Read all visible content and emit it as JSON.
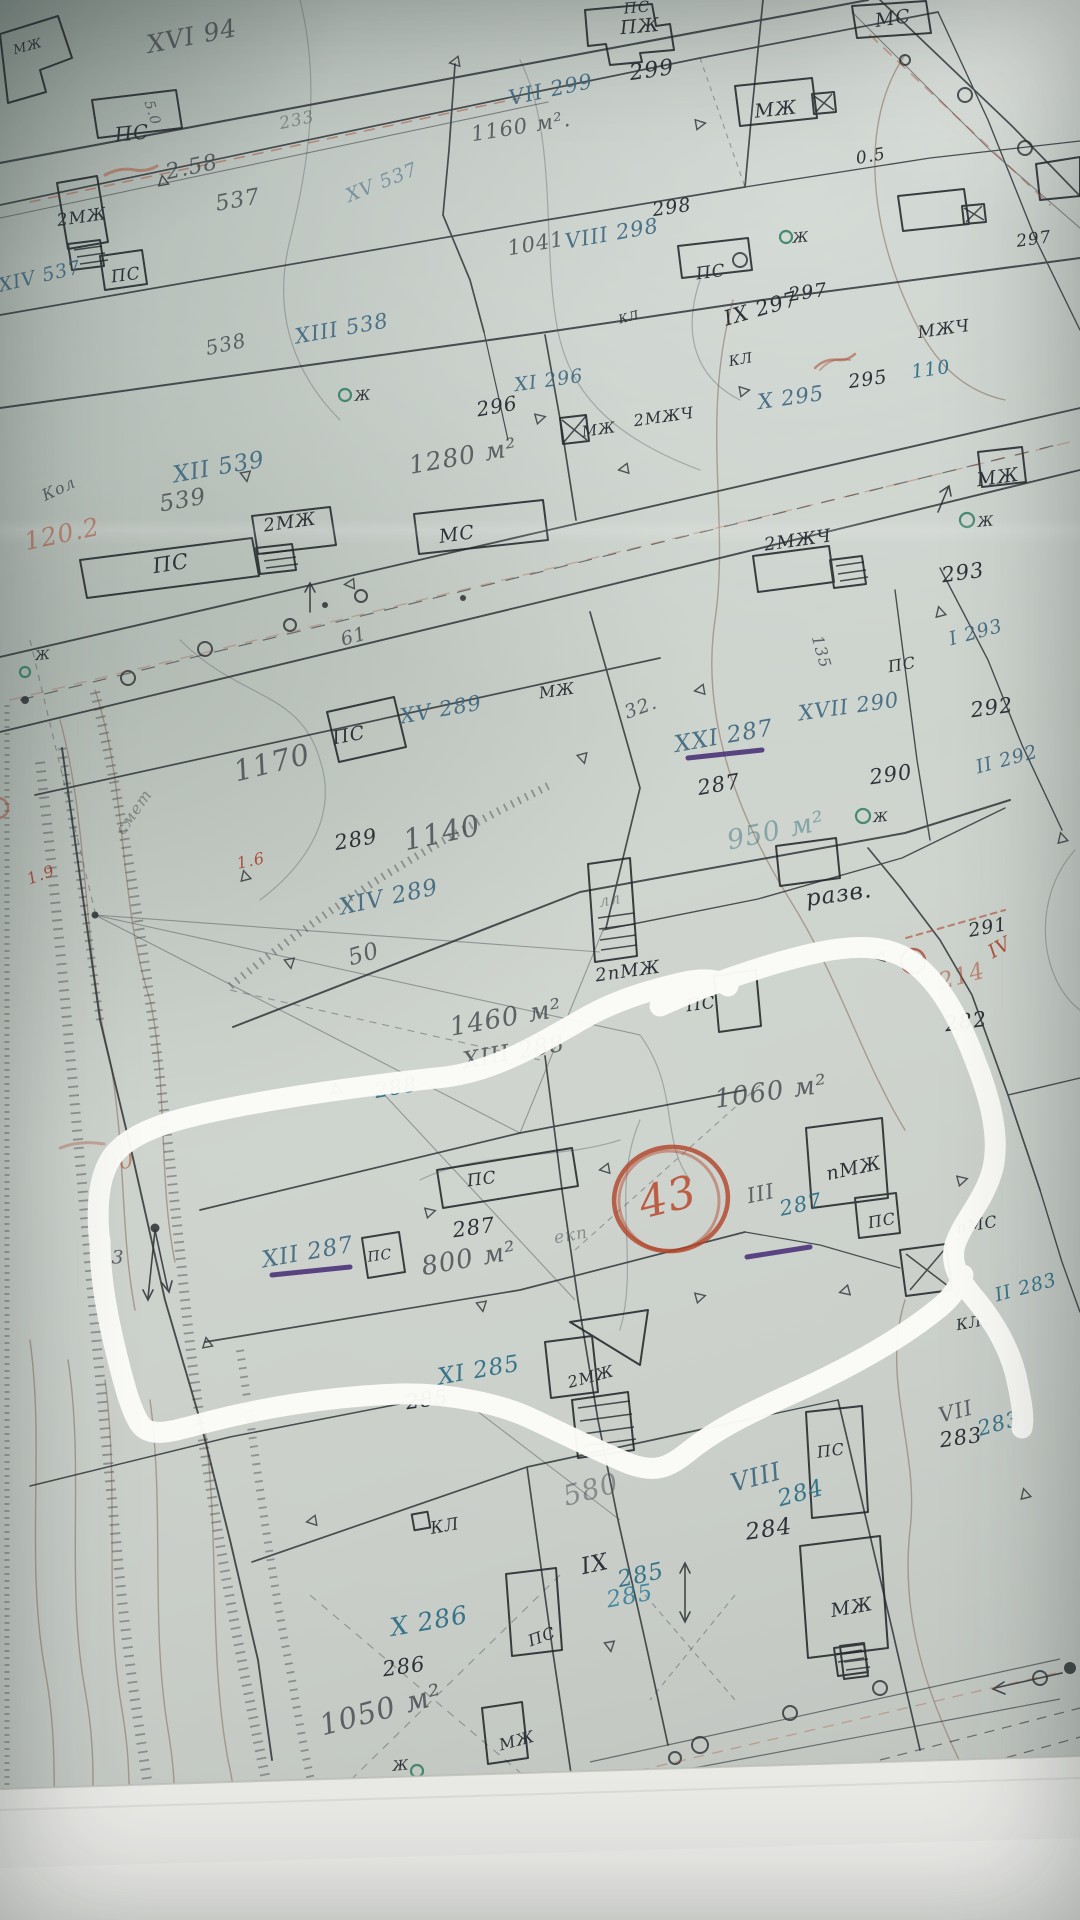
{
  "meta": {
    "kind": "photo of hand-drawn cadastral survey map",
    "highlight": "white marker loop around parcels 287/288",
    "circled_number": "43"
  },
  "palette": {
    "ink": "#2d3338",
    "pencil": "rgba(64,70,75,0.8)",
    "pencilFaint": "rgba(70,76,80,0.5)",
    "blue": "rgba(60,102,126,0.9)",
    "blueFaint": "rgba(60,102,126,0.55)",
    "teal": "rgba(42,108,132,0.92)",
    "tealBright": "rgba(36,120,150,0.8)",
    "tealFaint": "rgba(60,118,128,0.5)",
    "red": "rgba(168,68,44,0.9)",
    "redFaint": "rgba(172,74,48,0.55)",
    "red43": "rgba(186,72,44,0.85)",
    "green": "#2f7d63",
    "purple": "#452b75",
    "marker": "#fbfbf8"
  },
  "map": {
    "labels": [
      {
        "t": "МЖ",
        "x": 28,
        "y": 47,
        "r": -15,
        "s": 13,
        "c": "ink"
      },
      {
        "t": "XVI 94",
        "x": 192,
        "y": 36,
        "r": -11,
        "s": 25,
        "c": "pencil"
      },
      {
        "t": "ПС",
        "x": 132,
        "y": 133,
        "r": -6,
        "s": 20,
        "c": "ink"
      },
      {
        "t": "5.0",
        "x": 152,
        "y": 113,
        "r": 72,
        "s": 14,
        "c": "pencil"
      },
      {
        "t": "233",
        "x": 297,
        "y": 121,
        "r": -12,
        "s": 17,
        "c": "pencilFaint"
      },
      {
        "t": "2.58",
        "x": 192,
        "y": 168,
        "r": -12,
        "s": 22,
        "c": "pencil"
      },
      {
        "t": "537",
        "x": 238,
        "y": 201,
        "r": -10,
        "s": 22,
        "c": "pencil"
      },
      {
        "t": "XV 537",
        "x": 382,
        "y": 183,
        "r": -22,
        "s": 19,
        "c": "blueFaint"
      },
      {
        "t": "1160 м².",
        "x": 521,
        "y": 127,
        "r": -9,
        "s": 21,
        "c": "pencil"
      },
      {
        "t": "VII 299",
        "x": 551,
        "y": 90,
        "r": -12,
        "s": 21,
        "c": "blue"
      },
      {
        "t": "299",
        "x": 652,
        "y": 71,
        "r": -8,
        "s": 22,
        "c": "ink"
      },
      {
        "t": "ПЖ",
        "x": 640,
        "y": 27,
        "r": -5,
        "s": 19,
        "c": "ink"
      },
      {
        "t": "МЖ",
        "x": 776,
        "y": 110,
        "r": -6,
        "s": 19,
        "c": "ink"
      },
      {
        "t": "МС",
        "x": 893,
        "y": 19,
        "r": -8,
        "s": 19,
        "c": "ink"
      },
      {
        "t": "ПС",
        "x": 637,
        "y": 8,
        "r": -5,
        "s": 15,
        "c": "ink"
      },
      {
        "t": "0.5",
        "x": 871,
        "y": 157,
        "r": -10,
        "s": 17,
        "c": "ink"
      },
      {
        "t": "2МЖ",
        "x": 82,
        "y": 218,
        "r": -8,
        "s": 17,
        "c": "ink"
      },
      {
        "t": "XIV 537",
        "x": 40,
        "y": 277,
        "r": -13,
        "s": 19,
        "c": "blue"
      },
      {
        "t": "ПС",
        "x": 126,
        "y": 276,
        "r": -8,
        "s": 17,
        "c": "ink"
      },
      {
        "t": "538",
        "x": 226,
        "y": 344,
        "r": -12,
        "s": 20,
        "c": "pencil"
      },
      {
        "t": "XIII 538",
        "x": 342,
        "y": 329,
        "r": -10,
        "s": 21,
        "c": "blue"
      },
      {
        "t": "Ж",
        "x": 363,
        "y": 396,
        "r": -5,
        "s": 14,
        "c": "ink"
      },
      {
        "t": "296",
        "x": 497,
        "y": 406,
        "r": -10,
        "s": 20,
        "c": "ink"
      },
      {
        "t": "XI 296",
        "x": 549,
        "y": 381,
        "r": -8,
        "s": 19,
        "c": "blue"
      },
      {
        "t": "1280 м²",
        "x": 463,
        "y": 456,
        "r": -10,
        "s": 25,
        "c": "pencil"
      },
      {
        "t": "1041",
        "x": 536,
        "y": 244,
        "r": -10,
        "s": 21,
        "c": "pencil"
      },
      {
        "t": "VIII 298",
        "x": 612,
        "y": 234,
        "r": -10,
        "s": 21,
        "c": "blue"
      },
      {
        "t": "298",
        "x": 672,
        "y": 208,
        "r": -8,
        "s": 19,
        "c": "ink"
      },
      {
        "t": "297",
        "x": 1034,
        "y": 240,
        "r": -8,
        "s": 17,
        "c": "ink"
      },
      {
        "t": "МЖЧ",
        "x": 944,
        "y": 330,
        "r": -8,
        "s": 17,
        "c": "ink"
      },
      {
        "t": "Ж",
        "x": 801,
        "y": 238,
        "r": -5,
        "s": 14,
        "c": "ink"
      },
      {
        "t": "ПС",
        "x": 711,
        "y": 273,
        "r": -8,
        "s": 17,
        "c": "ink"
      },
      {
        "t": "IX 297",
        "x": 761,
        "y": 309,
        "r": -16,
        "s": 21,
        "c": "ink"
      },
      {
        "t": "297",
        "x": 808,
        "y": 293,
        "r": -8,
        "s": 19,
        "c": "ink"
      },
      {
        "t": "КЛ",
        "x": 741,
        "y": 360,
        "r": -10,
        "s": 14,
        "c": "ink"
      },
      {
        "t": "КЛ",
        "x": 629,
        "y": 317,
        "r": -15,
        "s": 12,
        "c": "ink"
      },
      {
        "t": "X 295",
        "x": 791,
        "y": 398,
        "r": -8,
        "s": 21,
        "c": "blue"
      },
      {
        "t": "295",
        "x": 868,
        "y": 380,
        "r": -8,
        "s": 19,
        "c": "ink"
      },
      {
        "t": "110",
        "x": 931,
        "y": 370,
        "r": -8,
        "s": 19,
        "c": "teal"
      },
      {
        "t": "МЖ",
        "x": 599,
        "y": 430,
        "r": -8,
        "s": 15,
        "c": "ink"
      },
      {
        "t": "2МЖЧ",
        "x": 664,
        "y": 417,
        "r": -8,
        "s": 16,
        "c": "ink"
      },
      {
        "t": "МЖ",
        "x": 998,
        "y": 478,
        "r": -8,
        "s": 19,
        "c": "ink"
      },
      {
        "t": "Ж",
        "x": 986,
        "y": 522,
        "r": -5,
        "s": 14,
        "c": "ink"
      },
      {
        "t": "293",
        "x": 963,
        "y": 573,
        "r": -8,
        "s": 21,
        "c": "ink"
      },
      {
        "t": "2МЖЧ",
        "x": 798,
        "y": 541,
        "r": -8,
        "s": 18,
        "c": "ink"
      },
      {
        "t": "МС",
        "x": 457,
        "y": 535,
        "r": -8,
        "s": 19,
        "c": "ink"
      },
      {
        "t": "2МЖ",
        "x": 290,
        "y": 523,
        "r": -8,
        "s": 18,
        "c": "ink"
      },
      {
        "t": "ПС",
        "x": 171,
        "y": 564,
        "r": -9,
        "s": 21,
        "c": "ink"
      },
      {
        "t": "539",
        "x": 183,
        "y": 501,
        "r": -10,
        "s": 23,
        "c": "pencil"
      },
      {
        "t": "XII 539",
        "x": 219,
        "y": 468,
        "r": -10,
        "s": 23,
        "c": "blue"
      },
      {
        "t": "Кол",
        "x": 59,
        "y": 489,
        "r": -25,
        "s": 16,
        "c": "pencil"
      },
      {
        "t": "120.2",
        "x": 62,
        "y": 534,
        "r": -12,
        "s": 25,
        "c": "redFaint"
      },
      {
        "t": "Ж",
        "x": 43,
        "y": 656,
        "r": -5,
        "s": 13,
        "c": "ink"
      },
      {
        "t": "61",
        "x": 354,
        "y": 637,
        "r": -15,
        "s": 19,
        "c": "pencil"
      },
      {
        "t": "XV 289",
        "x": 441,
        "y": 710,
        "r": -10,
        "s": 21,
        "c": "blue"
      },
      {
        "t": "ПС",
        "x": 349,
        "y": 736,
        "r": -11,
        "s": 19,
        "c": "ink"
      },
      {
        "t": "1170",
        "x": 272,
        "y": 763,
        "r": -14,
        "s": 29,
        "c": "pencil"
      },
      {
        "t": "смет",
        "x": 134,
        "y": 812,
        "r": -55,
        "s": 16,
        "c": "pencilFaint"
      },
      {
        "t": "289",
        "x": 356,
        "y": 840,
        "r": -10,
        "s": 21,
        "c": "ink"
      },
      {
        "t": "1140",
        "x": 442,
        "y": 833,
        "r": -12,
        "s": 29,
        "c": "pencil"
      },
      {
        "t": "XIV 289",
        "x": 389,
        "y": 898,
        "r": -12,
        "s": 23,
        "c": "blue"
      },
      {
        "t": "1.6",
        "x": 251,
        "y": 861,
        "r": -12,
        "s": 16,
        "c": "red"
      },
      {
        "t": "1.9",
        "x": 41,
        "y": 875,
        "r": -20,
        "s": 16,
        "c": "red"
      },
      {
        "t": "50",
        "x": 364,
        "y": 955,
        "r": -16,
        "s": 23,
        "c": "pencil"
      },
      {
        "t": "лл",
        "x": 610,
        "y": 900,
        "r": -10,
        "s": 16,
        "c": "pencilFaint"
      },
      {
        "t": "1460 м²",
        "x": 506,
        "y": 1018,
        "r": -10,
        "s": 26,
        "c": "pencil"
      },
      {
        "t": "XIII 288",
        "x": 514,
        "y": 1053,
        "r": -10,
        "s": 23,
        "c": "pencil"
      },
      {
        "t": "288",
        "x": 396,
        "y": 1088,
        "r": -10,
        "s": 21,
        "c": "teal"
      },
      {
        "t": "2пМЖ",
        "x": 628,
        "y": 972,
        "r": -8,
        "s": 18,
        "c": "ink"
      },
      {
        "t": "ПС",
        "x": 701,
        "y": 1005,
        "r": -8,
        "s": 17,
        "c": "ink"
      },
      {
        "t": "разв.",
        "x": 839,
        "y": 895,
        "r": -8,
        "s": 23,
        "c": "ink"
      },
      {
        "t": "291",
        "x": 988,
        "y": 928,
        "r": -10,
        "s": 19,
        "c": "ink"
      },
      {
        "t": "IV",
        "x": 1000,
        "y": 948,
        "r": -30,
        "s": 19,
        "c": "red"
      },
      {
        "t": "214",
        "x": 962,
        "y": 977,
        "r": -15,
        "s": 23,
        "c": "redFaint"
      },
      {
        "t": "282",
        "x": 966,
        "y": 1022,
        "r": -8,
        "s": 21,
        "c": "ink"
      },
      {
        "t": "1060 м²",
        "x": 771,
        "y": 1092,
        "r": -8,
        "s": 26,
        "c": "pencil"
      },
      {
        "t": "XXI 287",
        "x": 724,
        "y": 737,
        "r": -10,
        "s": 23,
        "c": "blue"
      },
      {
        "t": "287",
        "x": 719,
        "y": 785,
        "r": -10,
        "s": 21,
        "c": "ink"
      },
      {
        "t": "32.",
        "x": 641,
        "y": 708,
        "r": -20,
        "s": 19,
        "c": "pencil"
      },
      {
        "t": "135",
        "x": 821,
        "y": 652,
        "r": 74,
        "s": 16,
        "c": "pencil"
      },
      {
        "t": "XVII 290",
        "x": 849,
        "y": 707,
        "r": -8,
        "s": 21,
        "c": "blue"
      },
      {
        "t": "ПС",
        "x": 902,
        "y": 665,
        "r": -10,
        "s": 16,
        "c": "ink"
      },
      {
        "t": "290",
        "x": 891,
        "y": 775,
        "r": -8,
        "s": 21,
        "c": "ink"
      },
      {
        "t": "950 м²",
        "x": 776,
        "y": 831,
        "r": -12,
        "s": 27,
        "c": "tealFaint"
      },
      {
        "t": "Ж",
        "x": 881,
        "y": 818,
        "r": -5,
        "s": 13,
        "c": "ink"
      },
      {
        "t": "I 293",
        "x": 976,
        "y": 633,
        "r": -15,
        "s": 19,
        "c": "blue"
      },
      {
        "t": "292",
        "x": 992,
        "y": 708,
        "r": -8,
        "s": 21,
        "c": "ink"
      },
      {
        "t": "II 292",
        "x": 1007,
        "y": 760,
        "r": -15,
        "s": 19,
        "c": "blue"
      },
      {
        "t": "МЖ",
        "x": 557,
        "y": 691,
        "r": -8,
        "s": 16,
        "c": "ink"
      },
      {
        "t": "XII 287",
        "x": 308,
        "y": 1253,
        "r": -10,
        "s": 23,
        "c": "blue"
      },
      {
        "t": "ПС",
        "x": 380,
        "y": 1256,
        "r": -8,
        "s": 14,
        "c": "ink"
      },
      {
        "t": "287",
        "x": 474,
        "y": 1228,
        "r": -8,
        "s": 21,
        "c": "ink"
      },
      {
        "t": "800 м²",
        "x": 469,
        "y": 1259,
        "r": -10,
        "s": 26,
        "c": "pencil"
      },
      {
        "t": "екп",
        "x": 571,
        "y": 1236,
        "r": -10,
        "s": 17,
        "c": "pencilFaint"
      },
      {
        "t": "90",
        "x": 119,
        "y": 1163,
        "r": -10,
        "s": 23,
        "c": "redFaint"
      },
      {
        "t": "3",
        "x": 118,
        "y": 1258,
        "r": 0,
        "s": 19,
        "c": "pencil"
      },
      {
        "t": "XI 285",
        "x": 479,
        "y": 1371,
        "r": -10,
        "s": 23,
        "c": "teal"
      },
      {
        "t": "285",
        "x": 427,
        "y": 1400,
        "r": -8,
        "s": 21,
        "c": "ink"
      },
      {
        "t": "2МЖ",
        "x": 591,
        "y": 1377,
        "r": -15,
        "s": 16,
        "c": "ink"
      },
      {
        "t": "III",
        "x": 761,
        "y": 1194,
        "r": -12,
        "s": 21,
        "c": "pencil"
      },
      {
        "t": "287",
        "x": 801,
        "y": 1205,
        "r": -12,
        "s": 21,
        "c": "teal"
      },
      {
        "t": "пМЖ",
        "x": 854,
        "y": 1169,
        "r": -12,
        "s": 19,
        "c": "ink"
      },
      {
        "t": "ПС",
        "x": 882,
        "y": 1221,
        "r": -10,
        "s": 16,
        "c": "ink"
      },
      {
        "t": "пМС",
        "x": 977,
        "y": 1225,
        "r": -10,
        "s": 16,
        "c": "ink"
      },
      {
        "t": "II 283",
        "x": 1026,
        "y": 1288,
        "r": -15,
        "s": 19,
        "c": "teal"
      },
      {
        "t": "КЛ.",
        "x": 972,
        "y": 1323,
        "r": -10,
        "s": 15,
        "c": "ink"
      },
      {
        "t": "VII",
        "x": 956,
        "y": 1412,
        "r": -15,
        "s": 21,
        "c": "pencil"
      },
      {
        "t": "283",
        "x": 999,
        "y": 1424,
        "r": -15,
        "s": 21,
        "c": "teal"
      },
      {
        "t": "283",
        "x": 961,
        "y": 1438,
        "r": -8,
        "s": 21,
        "c": "ink"
      },
      {
        "t": "VIII",
        "x": 756,
        "y": 1477,
        "r": -15,
        "s": 25,
        "c": "blue"
      },
      {
        "t": "284",
        "x": 801,
        "y": 1494,
        "r": -15,
        "s": 23,
        "c": "teal"
      },
      {
        "t": "284",
        "x": 769,
        "y": 1530,
        "r": -8,
        "s": 23,
        "c": "ink"
      },
      {
        "t": "ПС",
        "x": 831,
        "y": 1451,
        "r": -8,
        "s": 16,
        "c": "ink"
      },
      {
        "t": "МЖ",
        "x": 852,
        "y": 1608,
        "r": -10,
        "s": 19,
        "c": "ink"
      },
      {
        "t": "580",
        "x": 591,
        "y": 1490,
        "r": -15,
        "s": 28,
        "c": "pencilFaint"
      },
      {
        "t": "IX",
        "x": 595,
        "y": 1565,
        "r": -12,
        "s": 23,
        "c": "ink"
      },
      {
        "t": "285",
        "x": 641,
        "y": 1576,
        "r": -12,
        "s": 23,
        "c": "teal"
      },
      {
        "t": "285",
        "x": 630,
        "y": 1597,
        "r": -10,
        "s": 23,
        "c": "tealBright"
      },
      {
        "t": "X 286",
        "x": 429,
        "y": 1621,
        "r": -10,
        "s": 25,
        "c": "teal"
      },
      {
        "t": "286",
        "x": 404,
        "y": 1667,
        "r": -8,
        "s": 21,
        "c": "ink"
      },
      {
        "t": "1050 м²",
        "x": 381,
        "y": 1710,
        "r": -15,
        "s": 29,
        "c": "pencil"
      },
      {
        "t": "Ж",
        "x": 401,
        "y": 1766,
        "r": -5,
        "s": 14,
        "c": "ink"
      },
      {
        "t": "КЛ",
        "x": 445,
        "y": 1527,
        "r": -10,
        "s": 17,
        "c": "ink"
      },
      {
        "t": "МЖ",
        "x": 517,
        "y": 1741,
        "r": -15,
        "s": 16,
        "c": "ink"
      },
      {
        "t": "ПС",
        "x": 542,
        "y": 1637,
        "r": -20,
        "s": 16,
        "c": "ink"
      },
      {
        "t": "ПС",
        "x": 482,
        "y": 1180,
        "r": -8,
        "s": 17,
        "c": "ink"
      },
      {
        "n": "circled-number-43",
        "t": "43",
        "x": 668,
        "y": 1198,
        "r": -14,
        "s": 44,
        "c": "red43"
      }
    ]
  }
}
